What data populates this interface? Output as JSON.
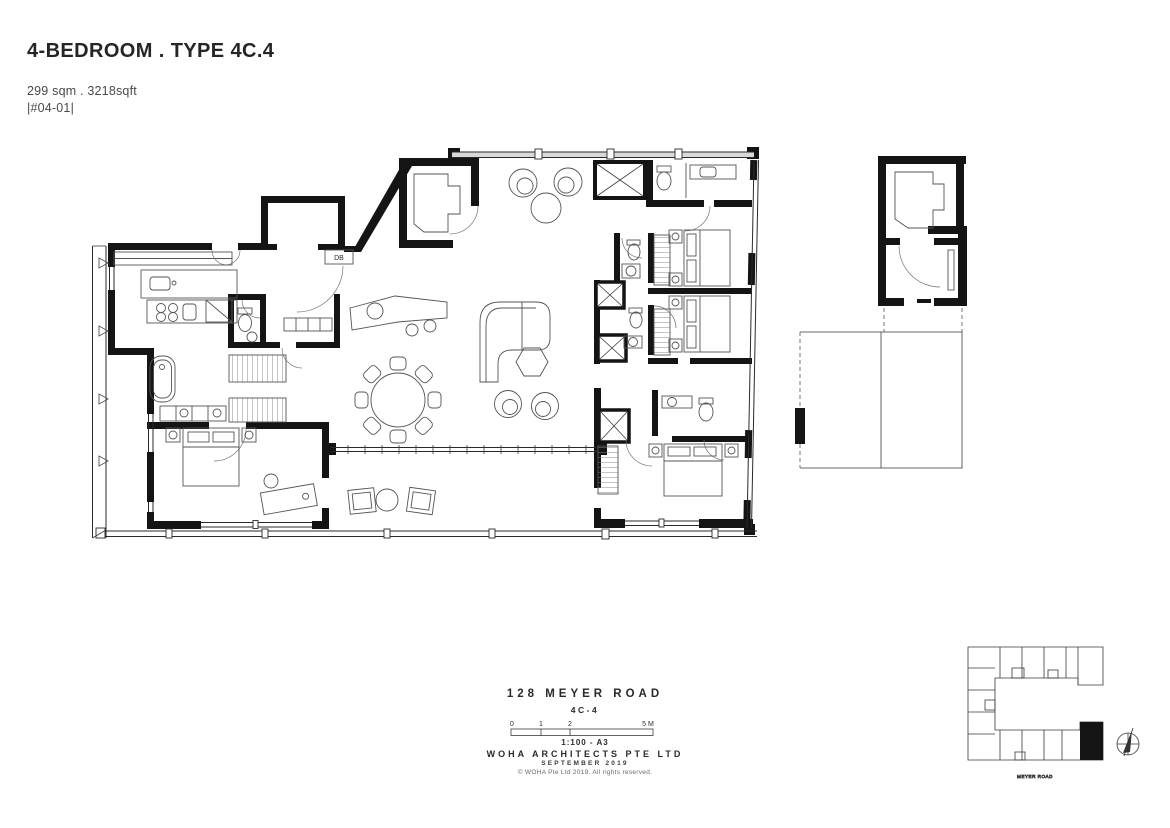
{
  "header": {
    "title": "4-BEDROOM . TYPE 4C.4",
    "area": "299 sqm . 3218sqft",
    "unit_number": "|#04-01|"
  },
  "plan": {
    "db_label": "DB"
  },
  "title_block": {
    "project": "128 MEYER ROAD",
    "unit_type": "4C-4",
    "scale": {
      "tick0": "0",
      "tick1": "1",
      "tick2": "2",
      "tick5": "5 M",
      "note": "1:100 - A3"
    },
    "firm": "WOHA ARCHITECTS PTE LTD",
    "date": "SEPTEMBER 2019",
    "copyright": "© WOHA Pte Ltd 2019.  All rights reserved."
  },
  "key_plan": {
    "road_label": "MEYER ROAD"
  },
  "colors": {
    "wall": "#141414",
    "furniture_line": "#555555",
    "paper": "#ffffff"
  }
}
